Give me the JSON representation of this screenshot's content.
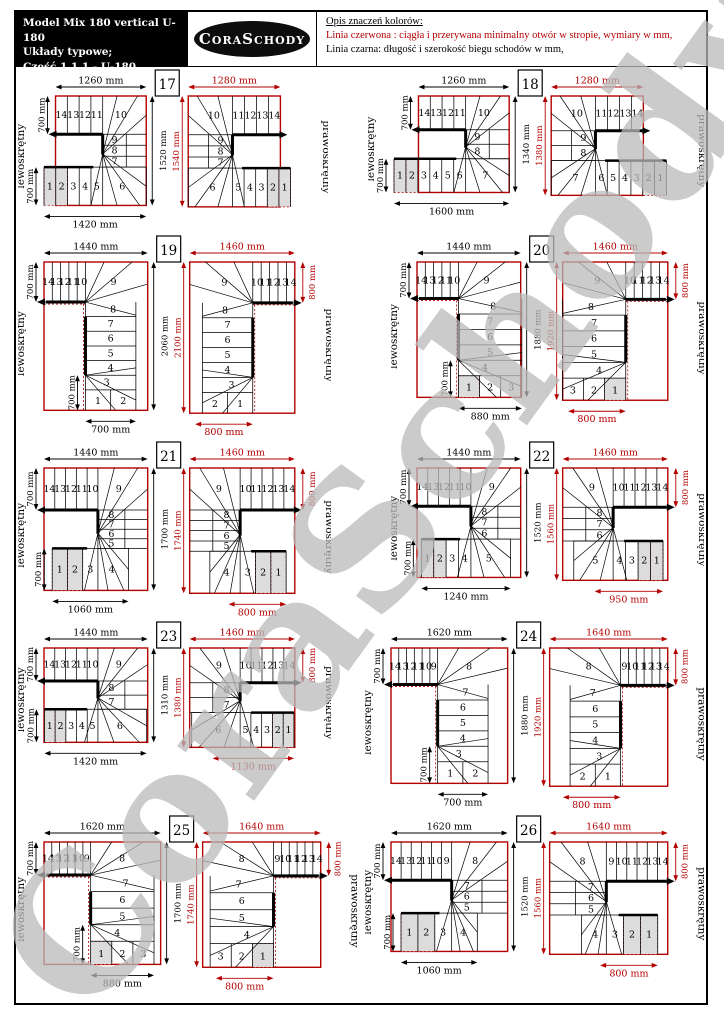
{
  "header": {
    "model_lines": [
      "Model Mix 180 vertical U-180",
      "Układy typowe;",
      "Część 1 1 1  -  U-180"
    ],
    "logo": "CoraSchody",
    "legend_title": "Opis znaczeń kolorów:",
    "legend_red": "Linia czerwona :  ciągła i przerywana minimalny otwór w stropie, wymiary w mm,",
    "legend_black": "Linia czarna: długość i  szerokość biegu schodów w mm,"
  },
  "watermark": "CoraSchody",
  "labels": {
    "left_variant": "lewoskrętny",
    "right_variant": "prawoskrętny"
  },
  "colors": {
    "red": "#b30000",
    "black": "#000000",
    "shaded": "#dcdcdc",
    "watermark": "#bababa"
  },
  "diagrams": [
    {
      "number": "17",
      "shape": "compact",
      "steps": {
        "top": [
          "14",
          "13",
          "12",
          "11"
        ],
        "top_wedge": "10",
        "mid": [
          "9",
          "8",
          "7"
        ],
        "vert": [],
        "upper_wedge": null,
        "lower_wedge": null,
        "bottom": [
          "1",
          "2",
          "3",
          "4",
          "5"
        ],
        "bottom_wedge": "6",
        "shaded_count": 2
      },
      "left": {
        "top": "1260 mm",
        "side": "700 mm",
        "side2": "700 mm",
        "inner": null,
        "height": "1520 mm",
        "bottom": "1420 mm"
      },
      "right": {
        "top": "1280 mm",
        "side": null,
        "height": "1540 mm",
        "bottom": null
      }
    },
    {
      "number": "18",
      "shape": "compact",
      "steps": {
        "top": [
          "14",
          "13",
          "12",
          "11"
        ],
        "top_wedge": "10",
        "mid": [
          "9",
          "8"
        ],
        "vert": [],
        "upper_wedge": null,
        "lower_wedge": null,
        "bottom": [
          "1",
          "2",
          "3",
          "4",
          "5",
          "6"
        ],
        "bottom_wedge": "7",
        "shaded_count": 2
      },
      "left": {
        "top": "1260 mm",
        "side": "700 mm",
        "side2": "700 mm",
        "inner": null,
        "height": "1340 mm",
        "bottom": "1600 mm"
      },
      "right": {
        "top": "1280 mm",
        "side": null,
        "height": "1380 mm",
        "bottom": null
      }
    },
    {
      "number": "19",
      "shape": "tall",
      "steps": {
        "top": [
          "14",
          "13",
          "12",
          "11",
          "10"
        ],
        "top_wedge": "9",
        "mid": [],
        "upper_wedge": "8",
        "vert": [
          "7",
          "6",
          "5",
          "4"
        ],
        "lower_wedge": "3",
        "bottom": [
          "1",
          "2"
        ],
        "bottom_wedge": null,
        "shaded_count": 0
      },
      "left": {
        "top": "1440 mm",
        "side": "700 mm",
        "side2": null,
        "inner": "700 mm",
        "height": "2060 mm",
        "bottom": "700 mm"
      },
      "right": {
        "top": "1460 mm",
        "side": "800 mm",
        "height": "2100 mm",
        "bottom": "800 mm"
      }
    },
    {
      "number": "20",
      "shape": "tall",
      "steps": {
        "top": [
          "14",
          "13",
          "12",
          "11",
          "10"
        ],
        "top_wedge": "9",
        "mid": [],
        "upper_wedge": "8",
        "vert": [
          "7",
          "6",
          "5"
        ],
        "lower_wedge": "4",
        "bottom": [
          "1",
          "2",
          "3"
        ],
        "bottom_wedge": null,
        "shaded_count": 1
      },
      "left": {
        "top": "1440 mm",
        "side": "700 mm",
        "side2": null,
        "inner": "700 mm",
        "height": "1880 mm",
        "bottom": "880 mm"
      },
      "right": {
        "top": "1460 mm",
        "side": "800 mm",
        "height": "1920 mm",
        "bottom": "800 mm"
      }
    },
    {
      "number": "21",
      "shape": "compact",
      "steps": {
        "top": [
          "14",
          "13",
          "12",
          "11",
          "10"
        ],
        "top_wedge": "9",
        "mid": [
          "8",
          "7",
          "6",
          "5"
        ],
        "vert": [],
        "upper_wedge": null,
        "lower_wedge": null,
        "bottom": [
          "1",
          "2",
          "3"
        ],
        "bottom_wedge": "4",
        "shaded_count": 2
      },
      "left": {
        "top": "1440 mm",
        "side": "700 mm",
        "side2": null,
        "inner": "700 mm",
        "height": "1700 mm",
        "bottom": "1060 mm"
      },
      "right": {
        "top": "1460 mm",
        "side": "800 mm",
        "height": "1740 mm",
        "bottom": "800 mm"
      }
    },
    {
      "number": "22",
      "shape": "compact",
      "steps": {
        "top": [
          "14",
          "13",
          "12",
          "11",
          "10"
        ],
        "top_wedge": "9",
        "mid": [
          "8",
          "7",
          "6"
        ],
        "vert": [],
        "upper_wedge": null,
        "lower_wedge": null,
        "bottom": [
          "1",
          "2",
          "3",
          "4"
        ],
        "bottom_wedge": "5",
        "shaded_count": 2
      },
      "left": {
        "top": "1440 mm",
        "side": "700 mm",
        "side2": null,
        "inner": "700 mm",
        "height": "1520 mm",
        "bottom": "1240 mm"
      },
      "right": {
        "top": "1460 mm",
        "side": "800 mm",
        "height": "1560 mm",
        "bottom": "950 mm"
      }
    },
    {
      "number": "23",
      "shape": "compact",
      "steps": {
        "top": [
          "14",
          "13",
          "12",
          "11",
          "10"
        ],
        "top_wedge": "9",
        "mid": [
          "8",
          "7"
        ],
        "vert": [],
        "upper_wedge": null,
        "lower_wedge": null,
        "bottom": [
          "1",
          "2",
          "3",
          "4",
          "5"
        ],
        "bottom_wedge": "6",
        "shaded_count": 2
      },
      "left": {
        "top": "1440 mm",
        "side": "700 mm",
        "side2": "700 mm",
        "inner": null,
        "height": "1310 mm",
        "bottom": "1420 mm"
      },
      "right": {
        "top": "1460 mm",
        "side": "800 mm",
        "height": "1380 mm",
        "bottom": "1130 mm"
      }
    },
    {
      "number": "24",
      "shape": "tall",
      "steps": {
        "top": [
          "14",
          "13",
          "12",
          "11",
          "10",
          "9"
        ],
        "top_wedge": "8",
        "mid": [],
        "upper_wedge": "7",
        "vert": [
          "6",
          "5",
          "4"
        ],
        "lower_wedge": "3",
        "bottom": [
          "1",
          "2"
        ],
        "bottom_wedge": null,
        "shaded_count": 0
      },
      "left": {
        "top": "1620 mm",
        "side": "700 mm",
        "side2": null,
        "inner": "700 mm",
        "height": "1880 mm",
        "bottom": "700 mm"
      },
      "right": {
        "top": "1640 mm",
        "side": "800 mm",
        "height": "1920 mm",
        "bottom": "800 mm"
      }
    },
    {
      "number": "25",
      "shape": "tall",
      "steps": {
        "top": [
          "14",
          "13",
          "12",
          "11",
          "10",
          "9"
        ],
        "top_wedge": "8",
        "mid": [],
        "upper_wedge": "7",
        "vert": [
          "6",
          "5"
        ],
        "lower_wedge": "4",
        "bottom": [
          "1",
          "2",
          "3"
        ],
        "bottom_wedge": null,
        "shaded_count": 1
      },
      "left": {
        "top": "1620 mm",
        "side": "700 mm",
        "side2": null,
        "inner": "700 mm",
        "height": "1700 mm",
        "bottom": "880 mm"
      },
      "right": {
        "top": "1640 mm",
        "side": "800 mm",
        "height": "1740 mm",
        "bottom": "800 mm"
      }
    },
    {
      "number": "26",
      "shape": "compact",
      "steps": {
        "top": [
          "14",
          "13",
          "12",
          "11",
          "10",
          "9"
        ],
        "top_wedge": "8",
        "mid": [
          "7",
          "6",
          "5"
        ],
        "vert": [],
        "upper_wedge": null,
        "lower_wedge": null,
        "bottom": [
          "1",
          "2",
          "3"
        ],
        "bottom_wedge": "4",
        "shaded_count": 2
      },
      "left": {
        "top": "1620 mm",
        "side": "700 mm",
        "side2": null,
        "inner": "700 mm",
        "height": "1520 mm",
        "bottom": "1060 mm"
      },
      "right": {
        "top": "1640 mm",
        "side": "800 mm",
        "height": "1560 mm",
        "bottom": "800 mm"
      }
    }
  ]
}
